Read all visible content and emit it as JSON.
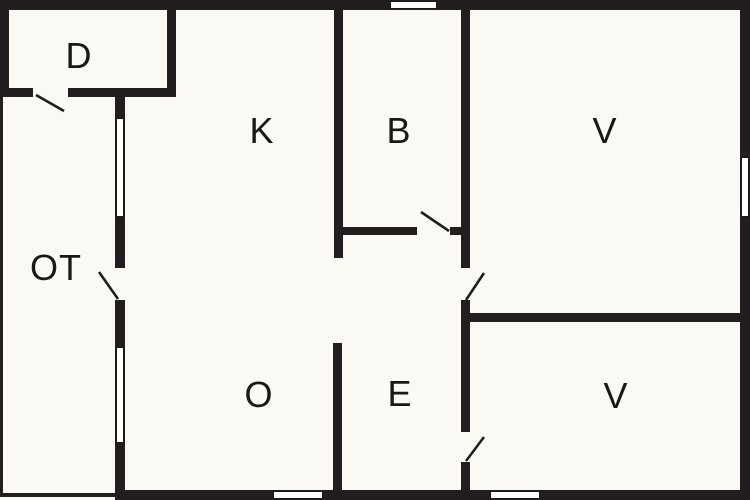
{
  "title": "Floor plan",
  "canvas": {
    "width": 750,
    "height": 500
  },
  "colors": {
    "background": "#faf9f4",
    "wall": "#221e1f",
    "window_fill": "#ffffff",
    "text": "#1a1718"
  },
  "rooms": [
    {
      "label": "D",
      "x": 79,
      "y": 56
    },
    {
      "label": "K",
      "x": 262,
      "y": 131
    },
    {
      "label": "B",
      "x": 399,
      "y": 131
    },
    {
      "label": "V",
      "x": 605,
      "y": 131
    },
    {
      "label": "OT",
      "x": 56,
      "y": 268
    },
    {
      "label": "O",
      "x": 259,
      "y": 395
    },
    {
      "label": "E",
      "x": 400,
      "y": 394
    },
    {
      "label": "V",
      "x": 616,
      "y": 396
    }
  ],
  "walls": [
    {
      "name": "top-outer-wall",
      "x": 0,
      "y": 0,
      "w": 750,
      "h": 10
    },
    {
      "name": "right-outer-wall",
      "x": 740,
      "y": 0,
      "w": 10,
      "h": 500
    },
    {
      "name": "bottom-outer-wall",
      "x": 115,
      "y": 490,
      "w": 635,
      "h": 10
    },
    {
      "name": "d-left-wall",
      "x": 0,
      "y": 0,
      "w": 9,
      "h": 97
    },
    {
      "name": "d-right-wall",
      "x": 167,
      "y": 0,
      "w": 9,
      "h": 97
    },
    {
      "name": "d-bottom-wall",
      "x": 0,
      "y": 88,
      "w": 176,
      "h": 9
    },
    {
      "name": "left-house-wall",
      "x": 115,
      "y": 88,
      "w": 10,
      "h": 412
    },
    {
      "name": "kitchen-bath-wall",
      "x": 334,
      "y": 10,
      "w": 9,
      "h": 248
    },
    {
      "name": "bath-bottom-wall",
      "x": 334,
      "y": 227,
      "w": 136,
      "h": 8
    },
    {
      "name": "center-right-wall",
      "x": 461,
      "y": 10,
      "w": 9,
      "h": 480
    },
    {
      "name": "v-rooms-divider-wall",
      "x": 461,
      "y": 313,
      "w": 289,
      "h": 9
    },
    {
      "name": "o-e-divider-wall",
      "x": 333,
      "y": 343,
      "w": 9,
      "h": 147
    },
    {
      "name": "terrace-left-edge",
      "x": 0,
      "y": 97,
      "w": 3,
      "h": 400
    },
    {
      "name": "terrace-bottom-edge",
      "x": 0,
      "y": 493,
      "w": 115,
      "h": 4
    }
  ],
  "windows": [
    {
      "name": "top-wall-window",
      "x": 390,
      "y": 1,
      "w": 47,
      "h": 8
    },
    {
      "name": "right-wall-window",
      "x": 741,
      "y": 157,
      "w": 8,
      "h": 60
    },
    {
      "name": "left-wall-upper-window",
      "x": 116,
      "y": 118,
      "w": 8,
      "h": 99
    },
    {
      "name": "left-wall-lower-window",
      "x": 116,
      "y": 347,
      "w": 8,
      "h": 96
    },
    {
      "name": "bottom-wall-window-o",
      "x": 273,
      "y": 491,
      "w": 50,
      "h": 8
    },
    {
      "name": "bottom-wall-window-v",
      "x": 490,
      "y": 491,
      "w": 50,
      "h": 8
    }
  ],
  "door_gaps": [
    {
      "name": "d-room-door-gap",
      "x": 33,
      "y": 88,
      "w": 35,
      "h": 9
    },
    {
      "name": "entry-door-gap",
      "x": 115,
      "y": 268,
      "w": 10,
      "h": 32
    },
    {
      "name": "bath-door-gap",
      "x": 417,
      "y": 227,
      "w": 33,
      "h": 8
    },
    {
      "name": "v-top-door-gap",
      "x": 461,
      "y": 268,
      "w": 9,
      "h": 32
    },
    {
      "name": "v-bottom-door-gap",
      "x": 461,
      "y": 432,
      "w": 9,
      "h": 30
    }
  ],
  "door_swings": [
    {
      "name": "d-room-door-swing",
      "x1": 36,
      "y1": 95,
      "x2": 64,
      "y2": 111
    },
    {
      "name": "entry-door-swing",
      "x1": 118,
      "y1": 299,
      "x2": 99,
      "y2": 272
    },
    {
      "name": "bath-door-swing",
      "x1": 449,
      "y1": 231,
      "x2": 421,
      "y2": 212
    },
    {
      "name": "v-top-door-swing",
      "x1": 466,
      "y1": 300,
      "x2": 484,
      "y2": 273
    },
    {
      "name": "v-bottom-door-swing",
      "x1": 466,
      "y1": 461,
      "x2": 484,
      "y2": 437
    }
  ]
}
